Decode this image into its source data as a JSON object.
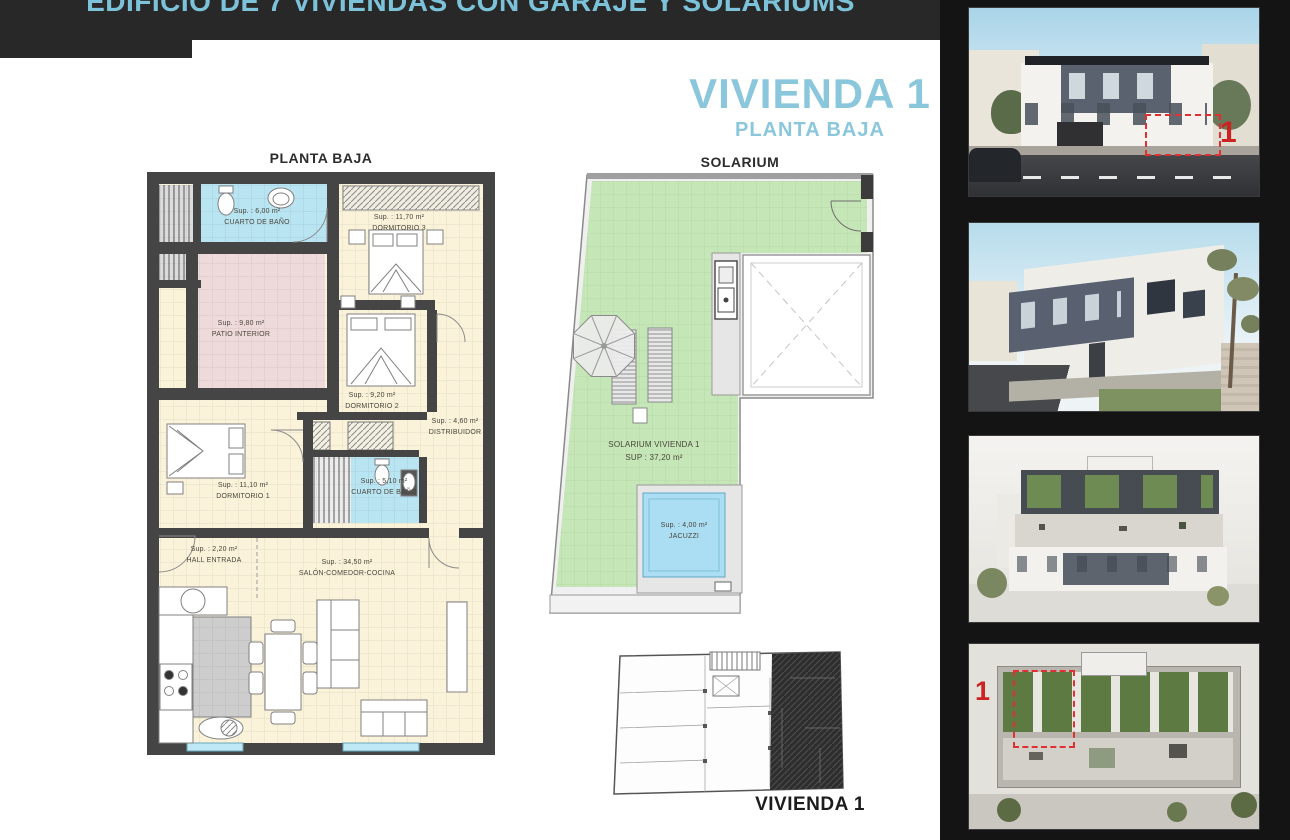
{
  "header": {
    "title": "EDIFICIO DE 7 VIVIENDAS CON GARAJE Y SOLARIUMS"
  },
  "title_block": {
    "main": "VIVIENDA 1",
    "subtitle": "PLANTA BAJA"
  },
  "floor_plan": {
    "title": "PLANTA BAJA",
    "rooms": [
      {
        "id": "bath1",
        "area": "Sup. : 6,00 m²",
        "name": "CUARTO DE BAÑO"
      },
      {
        "id": "dorm3",
        "area": "Sup. : 11,70 m²",
        "name": "DORMITORIO 3"
      },
      {
        "id": "patio",
        "area": "Sup. : 9,80 m²",
        "name": "PATIO INTERIOR"
      },
      {
        "id": "dorm2",
        "area": "Sup. : 9,20 m²",
        "name": "DORMITORIO 2"
      },
      {
        "id": "distribuidor",
        "area": "Sup. : 4,60 m²",
        "name": "DISTRIBUIDOR"
      },
      {
        "id": "dorm1",
        "area": "Sup. : 11,10 m²",
        "name": "DORMITORIO 1"
      },
      {
        "id": "bath2",
        "area": "Sup. : 5,10 m²",
        "name": "CUARTO DE BAÑO"
      },
      {
        "id": "hall",
        "area": "Sup. : 2,20 m²",
        "name": "HALL ENTRADA"
      },
      {
        "id": "salon",
        "area": "Sup. : 34,50 m²",
        "name": "SALÓN-COMEDOR-COCINA"
      }
    ]
  },
  "solarium_plan": {
    "title": "SOLARIUM",
    "label_line1": "SOLARIUM VIVIENDA  1",
    "label_line2": "SUP : 37,20 m²",
    "jacuzzi": {
      "area": "Sup. : 4,00 m²",
      "name": "JACUZZI"
    }
  },
  "key_plan": {
    "caption": "VIVIENDA 1"
  },
  "photos": [
    {
      "name": "front-elevation-render",
      "badge": "1"
    },
    {
      "name": "street-perspective-render"
    },
    {
      "name": "aerial-rear-render"
    },
    {
      "name": "rooftop-aerial-render",
      "badge": "1"
    }
  ],
  "colors": {
    "accent_blue": "#8bc7dc",
    "highlight_red": "#cc2222",
    "wall": "#454545",
    "bath": "#b9e4f2",
    "room": "#faf3da",
    "patio": "#eedada",
    "solarium_green": "#c5e6b6",
    "jacuzzi_blue": "#abdef2"
  }
}
